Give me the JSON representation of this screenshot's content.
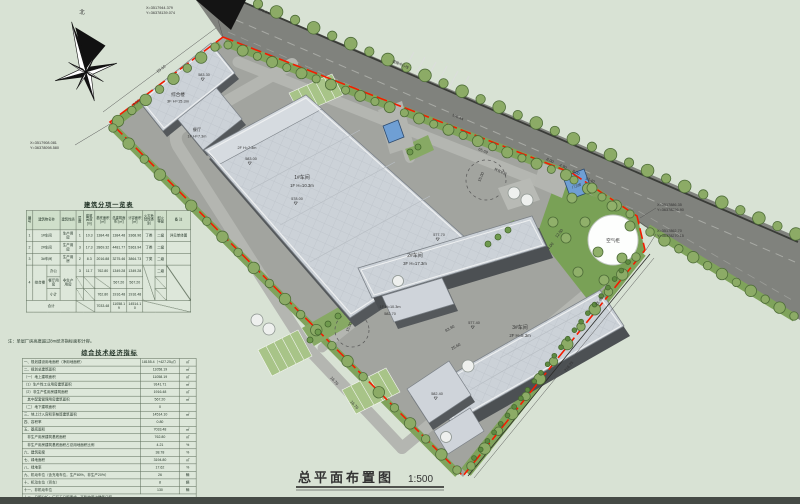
{
  "canvas": {
    "bg": "#d8e2d4",
    "boundary_red": "#f51b00",
    "road_gray": "#80827d",
    "tree_green": "#8cab66"
  },
  "title_block": {
    "title": "总平面布置图",
    "scale": "1:500"
  },
  "compass": {
    "label": "北"
  },
  "coords": {
    "top": {
      "x": "X=3517944.379",
      "y": "Y=36378139.074"
    },
    "west": {
      "x": "X=3517908.081",
      "y": "Y=36378098.580"
    },
    "east1": {
      "x": "X=3517886.35",
      "y": "Y=36378256.90"
    },
    "east2": {
      "x": "X=3517862.70",
      "y": "Y=36378270.15"
    }
  },
  "road": {
    "center_line_label": "道路中心线",
    "elev_top": "571.64",
    "elev_mid": "576.44"
  },
  "plan": {
    "zhl": {
      "name": "综合楼",
      "spec": "3F H=15.3m",
      "elev": "583.30"
    },
    "ct": {
      "name": "餐厅",
      "spec": "1F H=7.3m"
    },
    "b1": {
      "name": "1#车间",
      "spec": "1F H=10.3m",
      "elev": "578.00",
      "annex_spec": "2F H=7.3m",
      "annex_elev": "583.00"
    },
    "b2": {
      "name": "2#车间",
      "spec": "3F H=17.3m",
      "elev": "577.70",
      "annex_spec": "1F H=10.3m",
      "annex_elev": "582.70"
    },
    "b3": {
      "name": "3#车间",
      "spec": "2F H=8.3m",
      "elev": "577.40",
      "annex_elev": "582.40"
    },
    "air_tank": {
      "label": "空气柜"
    },
    "guard": {
      "label": "门卫房"
    },
    "turn_label": "转弯半径",
    "dims": {
      "d1": "55.10",
      "d2": "9.50",
      "d3": "65.69",
      "d4": "216.25",
      "d5": "16.79",
      "d6": "25.60",
      "d7": "83.90",
      "d8": "8.00",
      "d9": "4.90",
      "d10": "13.40",
      "d11": "15.00",
      "d12": "25.40",
      "d13": "12.50",
      "d14": "4.00"
    }
  },
  "tables": {
    "bl": {
      "title": "建筑分项一览表",
      "note": "注：单层厂房高度超过8m经济指标面积计容。",
      "rows": [
        [
          {
            "t": "编号",
            "cls": "hd"
          },
          {
            "t": "建筑物名称",
            "cs": 2,
            "cls": "hd"
          },
          {
            "t": "建筑性质",
            "cls": "hd"
          },
          {
            "t": "层数",
            "cls": "hd"
          },
          {
            "t": "建筑高度 [m]",
            "cls": "hd"
          },
          {
            "t": "基底面积 [㎡]",
            "cls": "hd"
          },
          {
            "t": "总建筑面积 [㎡]",
            "cls": "hd"
          },
          {
            "t": "计容面积 [㎡]",
            "cls": "hd"
          },
          {
            "t": "火灾危险性类别",
            "cls": "hd"
          },
          {
            "t": "耐火等级",
            "cls": "hd"
          },
          {
            "t": "备 注",
            "cls": "hd"
          }
        ],
        [
          {
            "t": "1"
          },
          {
            "t": "1#车间",
            "cs": 2
          },
          {
            "t": "生产用房"
          },
          {
            "t": "1"
          },
          {
            "t": "10.3"
          },
          {
            "t": "1384.48"
          },
          {
            "t": "1384.48"
          },
          {
            "t": "3368.96"
          },
          {
            "t": "丁类"
          },
          {
            "t": "二级"
          },
          {
            "t": "详见单体图"
          }
        ],
        [
          {
            "t": "2"
          },
          {
            "t": "2#车间",
            "cs": 2
          },
          {
            "t": "生产用房"
          },
          {
            "t": "3"
          },
          {
            "t": "17.3"
          },
          {
            "t": "2869.32"
          },
          {
            "t": "4481.77"
          },
          {
            "t": "5363.94"
          },
          {
            "t": "丁类"
          },
          {
            "t": "二级"
          },
          {
            "t": ""
          }
        ],
        [
          {
            "t": "3"
          },
          {
            "t": "3#车间",
            "cs": 2
          },
          {
            "t": "生产用房"
          },
          {
            "t": "2"
          },
          {
            "t": "8.3"
          },
          {
            "t": "2016.88"
          },
          {
            "t": "3275.46"
          },
          {
            "t": "3864.73"
          },
          {
            "t": "丁类"
          },
          {
            "t": "二级"
          },
          {
            "t": ""
          }
        ],
        [
          {
            "t": "4",
            "rs": 3
          },
          {
            "t": "综合楼",
            "rs": 3
          },
          {
            "t": "办公"
          },
          {
            "t": "非生产用房",
            "rs": 3
          },
          {
            "t": "3"
          },
          {
            "t": "11.7"
          },
          {
            "t": "762.80"
          },
          {
            "t": "1349.28"
          },
          {
            "t": "1349.28"
          },
          {
            "t": "",
            "cls": "diag",
            "rs": 3
          },
          {
            "t": "二级"
          },
          {
            "t": "",
            "cls": "diag",
            "rs": 3
          }
        ],
        [
          {
            "t": "餐厅用房"
          },
          {
            "t": "",
            "cls": "diag"
          },
          {
            "t": "",
            "cls": "diag"
          },
          {
            "t": "",
            "cls": "diag"
          },
          {
            "t": "567.20"
          },
          {
            "t": "567.20"
          },
          {
            "t": "",
            "cls": "diag"
          }
        ],
        [
          {
            "t": "小计"
          },
          {
            "t": "",
            "cls": "diag"
          },
          {
            "t": "",
            "cls": "diag"
          },
          {
            "t": "762.80"
          },
          {
            "t": "1916.48"
          },
          {
            "t": "1916.48"
          },
          {
            "t": "",
            "cls": "diag"
          }
        ],
        [
          {
            "t": "合计",
            "cs": 4
          },
          {
            "t": "",
            "cls": "diag",
            "cs": 2
          },
          {
            "t": "7033.48"
          },
          {
            "t": "11058.19"
          },
          {
            "t": "14514.10"
          },
          {
            "t": "",
            "cls": "diag",
            "cs": 3
          }
        ]
      ]
    },
    "ind": {
      "title": "综合技术经济指标",
      "rows": [
        [
          {
            "t": "一、规划建设用地面积（净用地面积）"
          },
          {
            "t": "18155.4（+427.25㎡）"
          },
          {
            "t": "㎡"
          }
        ],
        [
          {
            "t": "二、规划总建筑面积"
          },
          {
            "t": "11058.19"
          },
          {
            "t": "㎡"
          }
        ],
        [
          {
            "t": "（一）地上建筑面积"
          },
          {
            "t": "11058.19"
          },
          {
            "t": "㎡"
          }
        ],
        [
          {
            "t": "（1）生产性工业用房建筑面积"
          },
          {
            "t": "9141.71"
          },
          {
            "t": "㎡"
          }
        ],
        [
          {
            "t": "（2）非生产性用房建筑面积"
          },
          {
            "t": "1916.48"
          },
          {
            "t": "㎡"
          }
        ],
        [
          {
            "t": "　其中配套管理用房建筑面积"
          },
          {
            "t": "567.20"
          },
          {
            "t": "㎡"
          }
        ],
        [
          {
            "t": "（二）地下建筑面积"
          },
          {
            "t": "0"
          },
          {
            "t": ""
          }
        ],
        [
          {
            "t": "三、地上计入容积率核算建筑面积"
          },
          {
            "t": "14514.10"
          },
          {
            "t": "㎡"
          }
        ],
        [
          {
            "t": "四、容积率"
          },
          {
            "t": "0.80"
          },
          {
            "t": ""
          }
        ],
        [
          {
            "t": "五、基底面积"
          },
          {
            "t": "7033.48"
          },
          {
            "t": "㎡"
          }
        ],
        [
          {
            "t": "　非生产用房建筑基底面积"
          },
          {
            "t": "762.80"
          },
          {
            "t": "㎡"
          }
        ],
        [
          {
            "t": "　非生产用房建筑基底面积占总用地面积比例"
          },
          {
            "t": "4.21"
          },
          {
            "t": "%"
          }
        ],
        [
          {
            "t": "六、建筑密度"
          },
          {
            "t": "38.78"
          },
          {
            "t": "%"
          }
        ],
        [
          {
            "t": "七、绿地面积"
          },
          {
            "t": "3194.80"
          },
          {
            "t": "㎡"
          }
        ],
        [
          {
            "t": "八、绿地率"
          },
          {
            "t": "17.62"
          },
          {
            "t": "%"
          }
        ],
        [
          {
            "t": "九、机动车位（含充电车位，生产80%，非生产20%）"
          },
          {
            "t": "26"
          },
          {
            "t": "辆"
          }
        ],
        [
          {
            "t": "十、机动车位（货车）"
          },
          {
            "t": "8"
          },
          {
            "t": "辆"
          }
        ],
        [
          {
            "t": "十一、非机动车位"
          },
          {
            "t": "130"
          },
          {
            "t": "辆"
          }
        ],
        [
          {
            "t": "十二、日照分析：厂区无日照要求，不影响周边建筑日照。",
            "cs": 3
          }
        ]
      ]
    }
  }
}
